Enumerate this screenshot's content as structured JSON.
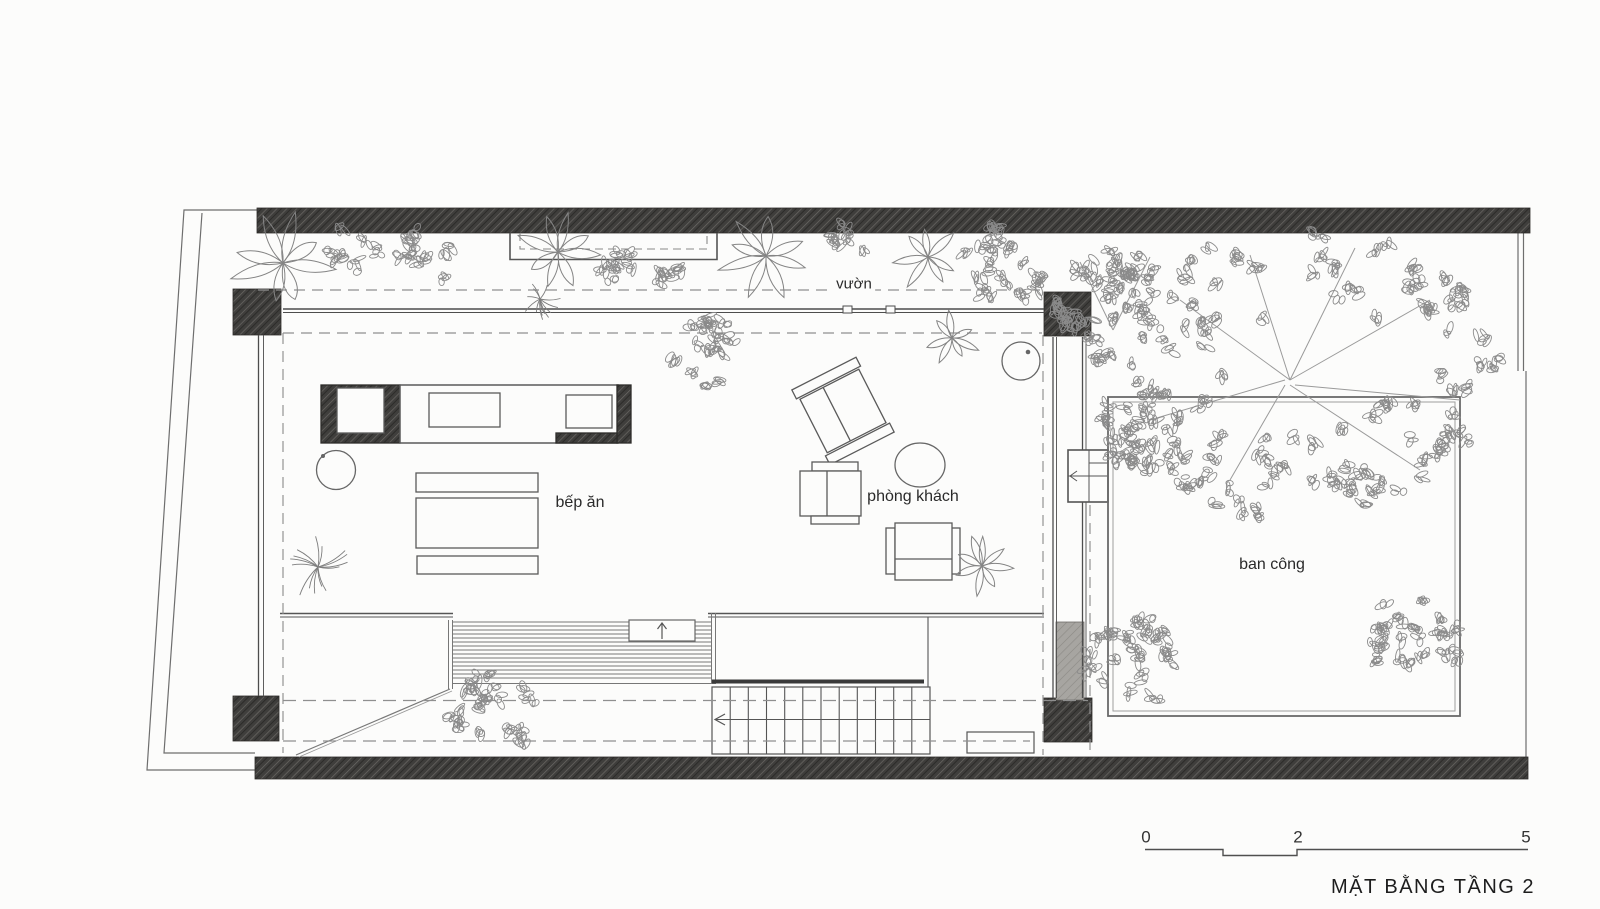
{
  "plan": {
    "room_labels": {
      "garden": "vườn",
      "dining_kitchen": "bếp ăn",
      "living_room": "phòng khách",
      "balcony": "ban công"
    },
    "title": "MẶT BẰNG TẦNG 2",
    "scale_bar": {
      "start": "0",
      "middle": "2",
      "end": "5"
    },
    "colors": {
      "paper": "#fcfcfb",
      "wall_fill": "#3f3e3c",
      "line": "#5a5a5a",
      "pencil": "#8a8a8a"
    }
  }
}
